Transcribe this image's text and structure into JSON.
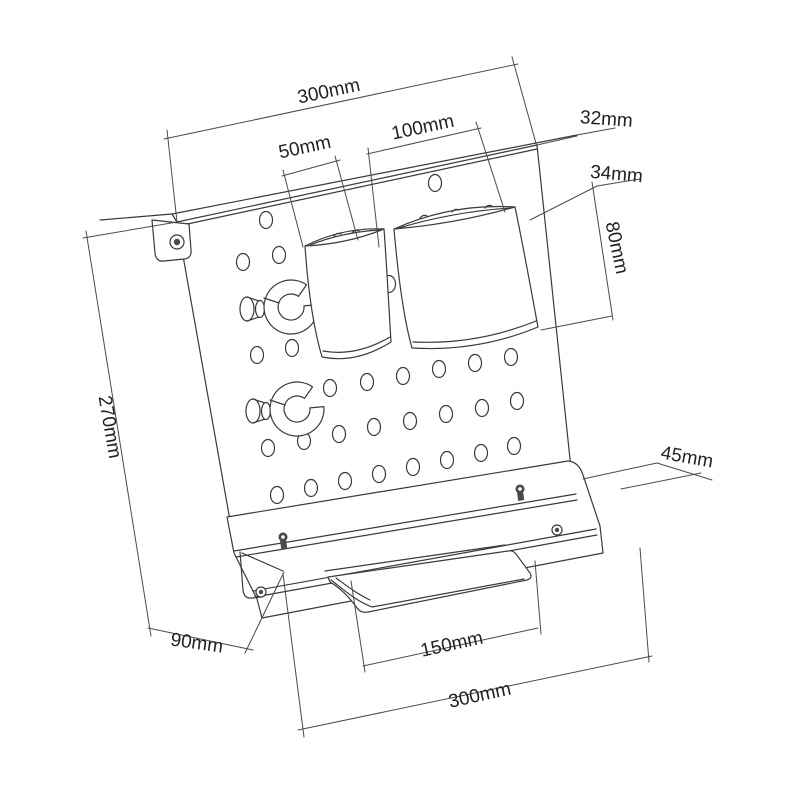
{
  "diagram": {
    "subject": "wall pegboard organizer with two cups, two cable hooks and bottom shelf",
    "unit": "mm",
    "dims": {
      "top_width": {
        "label": "300mm",
        "value": 300
      },
      "small_cup_width": {
        "label": "50mm",
        "value": 50
      },
      "large_cup_width": {
        "label": "100mm",
        "value": 100
      },
      "top_lip_depth": {
        "label": "32mm",
        "value": 32
      },
      "cup_depth": {
        "label": "34mm",
        "value": 34
      },
      "cup_height": {
        "label": "80mm",
        "value": 80
      },
      "panel_height": {
        "label": "270mm",
        "value": 270
      },
      "shelf_depth_left": {
        "label": "90mm",
        "value": 90
      },
      "shelf_depth_right": {
        "label": "45mm",
        "value": 45
      },
      "cradle_width": {
        "label": "150mm",
        "value": 150
      },
      "bottom_width": {
        "label": "300mm",
        "value": 300
      }
    }
  }
}
